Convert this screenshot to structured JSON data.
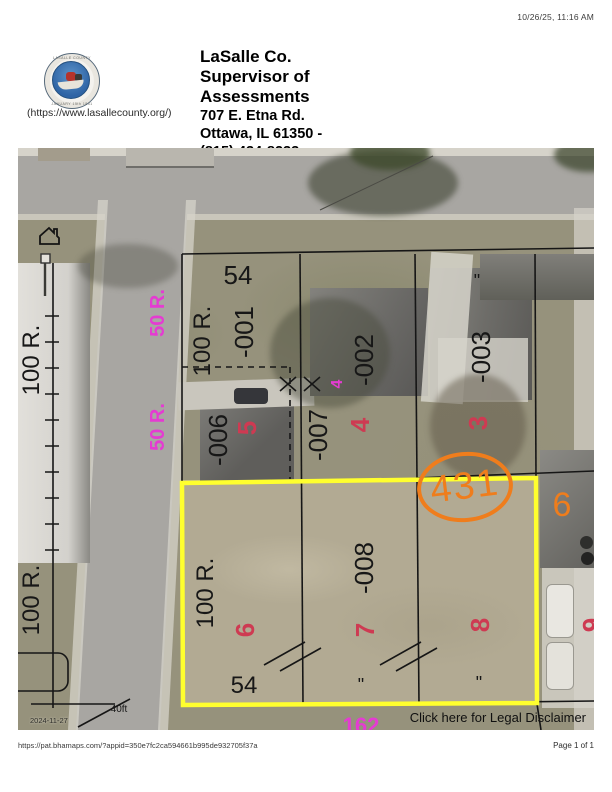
{
  "header": {
    "timestamp": "10/26/25, 11:16 AM",
    "seal_alt": "LaSalle County seal",
    "site_link": "(https://www.lasallecounty.org/)",
    "org_lines": [
      "LaSalle Co.",
      "Supervisor of",
      "Assessments"
    ],
    "address_lines": [
      "707 E. Etna Rd.",
      "Ottawa, IL 61350 -",
      "(815) 434-8233"
    ]
  },
  "map": {
    "highlighted_parcel": "431",
    "legal_disclaimer": "Click here for Legal Disclaimer",
    "imagery_date": "2024-11-27",
    "scale_label": "40ft",
    "colors": {
      "parcel_text": "#171717",
      "lot_number_red": "#ce3a52",
      "dimension_magenta": "#e53bd2",
      "highlight_orange": "#ef7d1c",
      "selection_yellow": "#ffff2e"
    },
    "annotations": [
      {
        "text": "54",
        "color": "black",
        "x": 220,
        "y": 127,
        "size": 26,
        "rot": false
      },
      {
        "text": "100 R.",
        "color": "black",
        "x": 185,
        "y": 193,
        "size": 24,
        "rot": true
      },
      {
        "text": "-001",
        "color": "black",
        "x": 226,
        "y": 184,
        "size": 26,
        "rot": true
      },
      {
        "text": "-002",
        "color": "black",
        "x": 346,
        "y": 212,
        "size": 26,
        "rot": true
      },
      {
        "text": "-003",
        "color": "black",
        "x": 463,
        "y": 209,
        "size": 26,
        "rot": true
      },
      {
        "text": "-006",
        "color": "black",
        "x": 200,
        "y": 292,
        "size": 26,
        "rot": true
      },
      {
        "text": "-007",
        "color": "black",
        "x": 300,
        "y": 287,
        "size": 26,
        "rot": true
      },
      {
        "text": "-008",
        "color": "black",
        "x": 346,
        "y": 420,
        "size": 26,
        "rot": true
      },
      {
        "text": "100 R.",
        "color": "black",
        "x": 188,
        "y": 445,
        "size": 24,
        "rot": true
      },
      {
        "text": "100 R.",
        "color": "black",
        "x": 14,
        "y": 212,
        "size": 24,
        "rot": true
      },
      {
        "text": "100 R.",
        "color": "black",
        "x": 14,
        "y": 452,
        "size": 24,
        "rot": true
      },
      {
        "text": "54",
        "color": "black",
        "x": 226,
        "y": 538,
        "size": 24,
        "rot": false
      },
      {
        "text": "\"",
        "color": "black",
        "x": 459,
        "y": 133,
        "size": 18,
        "rot": false
      },
      {
        "text": "\"",
        "color": "black",
        "x": 343,
        "y": 537,
        "size": 18,
        "rot": false
      },
      {
        "text": "\"",
        "color": "black",
        "x": 461,
        "y": 535,
        "size": 18,
        "rot": false
      },
      {
        "text": "40ft",
        "color": "black",
        "x": 101,
        "y": 562,
        "size": 10,
        "rot": false
      },
      {
        "text": "5",
        "color": "red",
        "x": 229,
        "y": 280,
        "size": 26,
        "rot": true
      },
      {
        "text": "4",
        "color": "red",
        "x": 342,
        "y": 277,
        "size": 26,
        "rot": true
      },
      {
        "text": "3",
        "color": "red",
        "x": 460,
        "y": 275,
        "size": 26,
        "rot": true
      },
      {
        "text": "6",
        "color": "red",
        "x": 227,
        "y": 482,
        "size": 26,
        "rot": true
      },
      {
        "text": "7",
        "color": "red",
        "x": 347,
        "y": 482,
        "size": 26,
        "rot": true
      },
      {
        "text": "8",
        "color": "red",
        "x": 462,
        "y": 477,
        "size": 26,
        "rot": true
      },
      {
        "text": "9",
        "color": "red",
        "x": 574,
        "y": 477,
        "size": 26,
        "rot": true
      },
      {
        "text": "50 R.",
        "color": "magenta",
        "x": 140,
        "y": 165,
        "size": 20,
        "rot": true
      },
      {
        "text": "50 R.",
        "color": "magenta",
        "x": 140,
        "y": 279,
        "size": 20,
        "rot": true
      },
      {
        "text": "4",
        "color": "magenta",
        "x": 320,
        "y": 236,
        "size": 16,
        "rot": true
      },
      {
        "text": "162",
        "color": "magenta",
        "x": 343,
        "y": 578,
        "size": 22,
        "rot": false
      },
      {
        "text": "6",
        "color": "orange",
        "x": 544,
        "y": 357,
        "size": 34,
        "rot": false
      }
    ]
  },
  "footer": {
    "url": "https://pat.bhamaps.com/?appid=350e7fc2ca594661b995de932705f37a",
    "page": "Page 1 of 1"
  }
}
